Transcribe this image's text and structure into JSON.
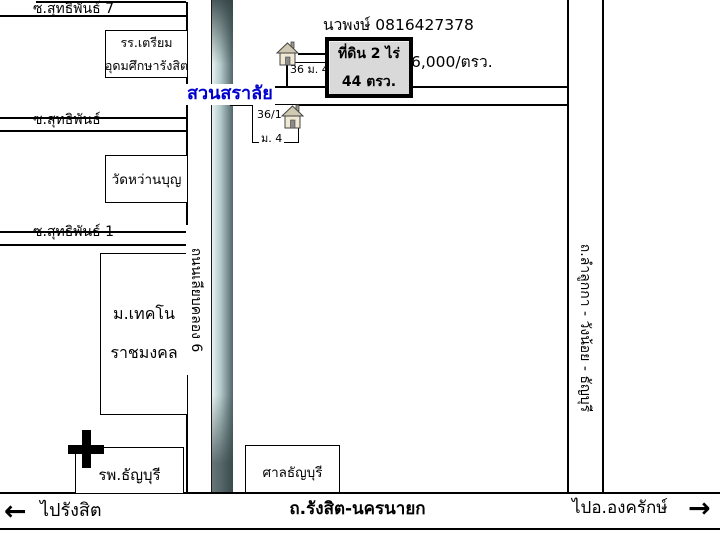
{
  "map": {
    "sois": [
      {
        "label": "ซ.สุทธิพันธ์ 7"
      },
      {
        "label": "ซ.สุทธิพันธ์"
      },
      {
        "label": "ซ.สุทธิพันธ์ 1"
      }
    ],
    "places": {
      "school_line1": "รร.เตรียม",
      "school_line2": "อุดมศึกษารังสิต",
      "temple": "วัดหว่านบุญ",
      "university_line1": "ม.เทคโน",
      "university_line2": "ราชมงคล",
      "hospital": "รพ.ธัญบุรี",
      "court": "ศาลธัญบุรี",
      "garden": "สวนสราลัย"
    },
    "listing": {
      "contact_name_phone": "นวพงษ์  0816427378",
      "plot_line1": "ที่ดิน 2 ไร่",
      "plot_line2": "44 ตรว.",
      "price": "6,000/ตรว.",
      "house1_address": "36 ม. 4",
      "house2_address": "36/1",
      "house2_moo": "ม. 4"
    },
    "roads": {
      "left_vertical": "ถนนเลียบคลอง 6",
      "right_vertical": "ถ.ลำลูกกา - วังน้อย - ธัญบุรี",
      "bottom_main": "ถ.รังสิต-นครนายก"
    },
    "directions": {
      "west_label": "ไปรังสิต",
      "west_arrow": "←",
      "east_label": "ไปอ.องครักษ์",
      "east_arrow": "→"
    },
    "colors": {
      "garden_label": "#0000cc",
      "road_gradient_light": "#e7f2f2",
      "road_gradient_dark": "#51666a",
      "plot_fill": "#d9d9d9",
      "line": "#000000"
    }
  }
}
